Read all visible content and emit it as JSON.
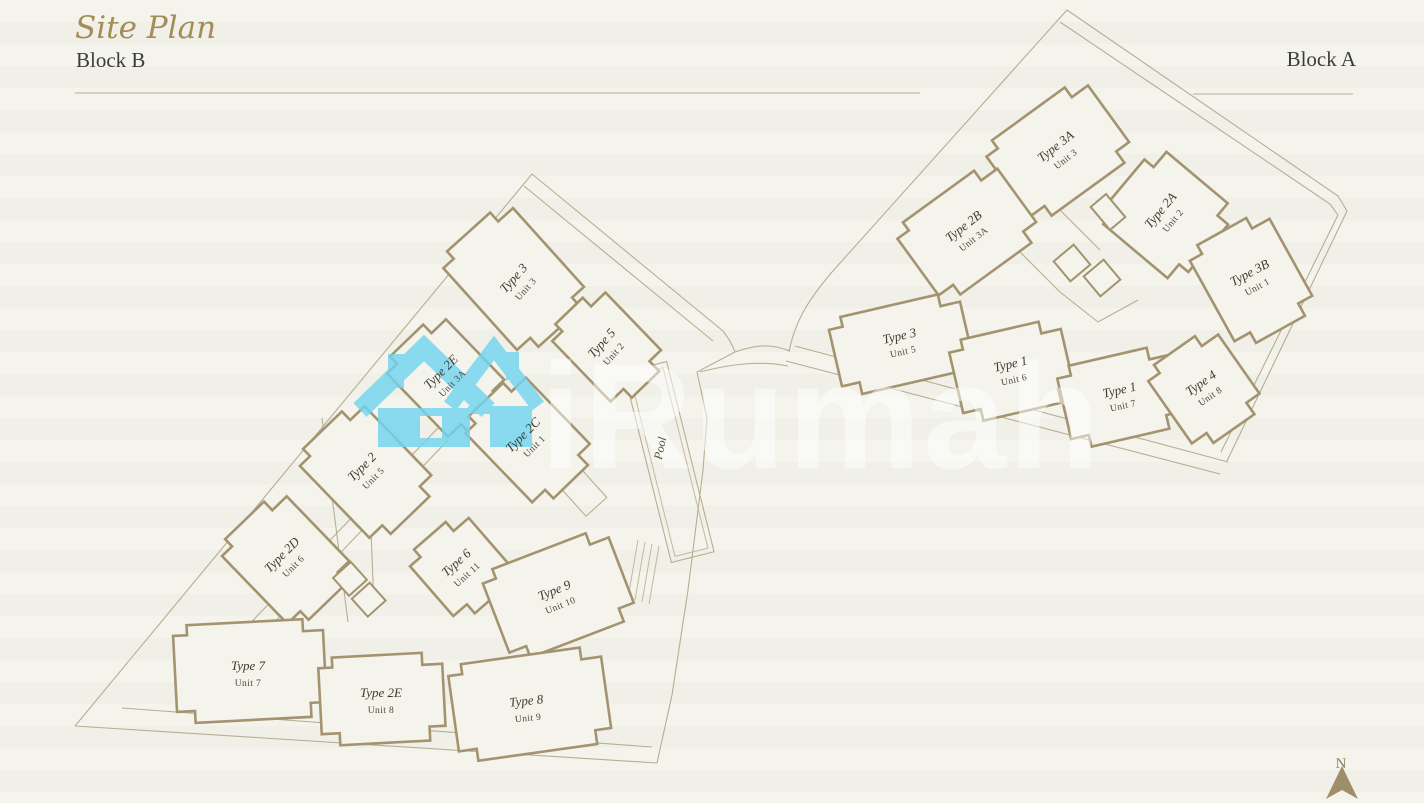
{
  "header": {
    "title": "Site Plan",
    "left_block_label": "Block B",
    "right_block_label": "Block A"
  },
  "watermark": {
    "brand": "iRumah"
  },
  "compass": {
    "north": "N"
  },
  "site": {
    "pool_label": "Pool",
    "block_b_units": [
      {
        "type": "Type 3",
        "unit": "Unit 3"
      },
      {
        "type": "Type 5",
        "unit": "Unit 2"
      },
      {
        "type": "Type 2E",
        "unit": "Unit 3A"
      },
      {
        "type": "Type 2C",
        "unit": "Unit 1"
      },
      {
        "type": "Type 2",
        "unit": "Unit 5"
      },
      {
        "type": "Type 2D",
        "unit": "Unit 6"
      },
      {
        "type": "Type 6",
        "unit": "Unit 11"
      },
      {
        "type": "Type 9",
        "unit": "Unit 10"
      },
      {
        "type": "Type 7",
        "unit": "Unit 7"
      },
      {
        "type": "Type 2E",
        "unit": "Unit 8"
      },
      {
        "type": "Type 8",
        "unit": "Unit 9"
      }
    ],
    "block_a_units": [
      {
        "type": "Type 3A",
        "unit": "Unit 3"
      },
      {
        "type": "Type 2B",
        "unit": "Unit 3A"
      },
      {
        "type": "Type 2A",
        "unit": "Unit 2"
      },
      {
        "type": "Type 3B",
        "unit": "Unit 1"
      },
      {
        "type": "Type 3",
        "unit": "Unit 5"
      },
      {
        "type": "Type 1",
        "unit": "Unit 6"
      },
      {
        "type": "Type 1",
        "unit": "Unit 7"
      },
      {
        "type": "Type 4",
        "unit": "Unit 8"
      }
    ]
  },
  "colors": {
    "background": "#f2f2ea",
    "wall_line": "#a3936f",
    "thin_line": "#b9ad92",
    "accent_gold": "#a28e58",
    "text_dark": "#3c3c39",
    "logo_blue": "#72d5f0",
    "watermark_white": "#ffffff"
  }
}
